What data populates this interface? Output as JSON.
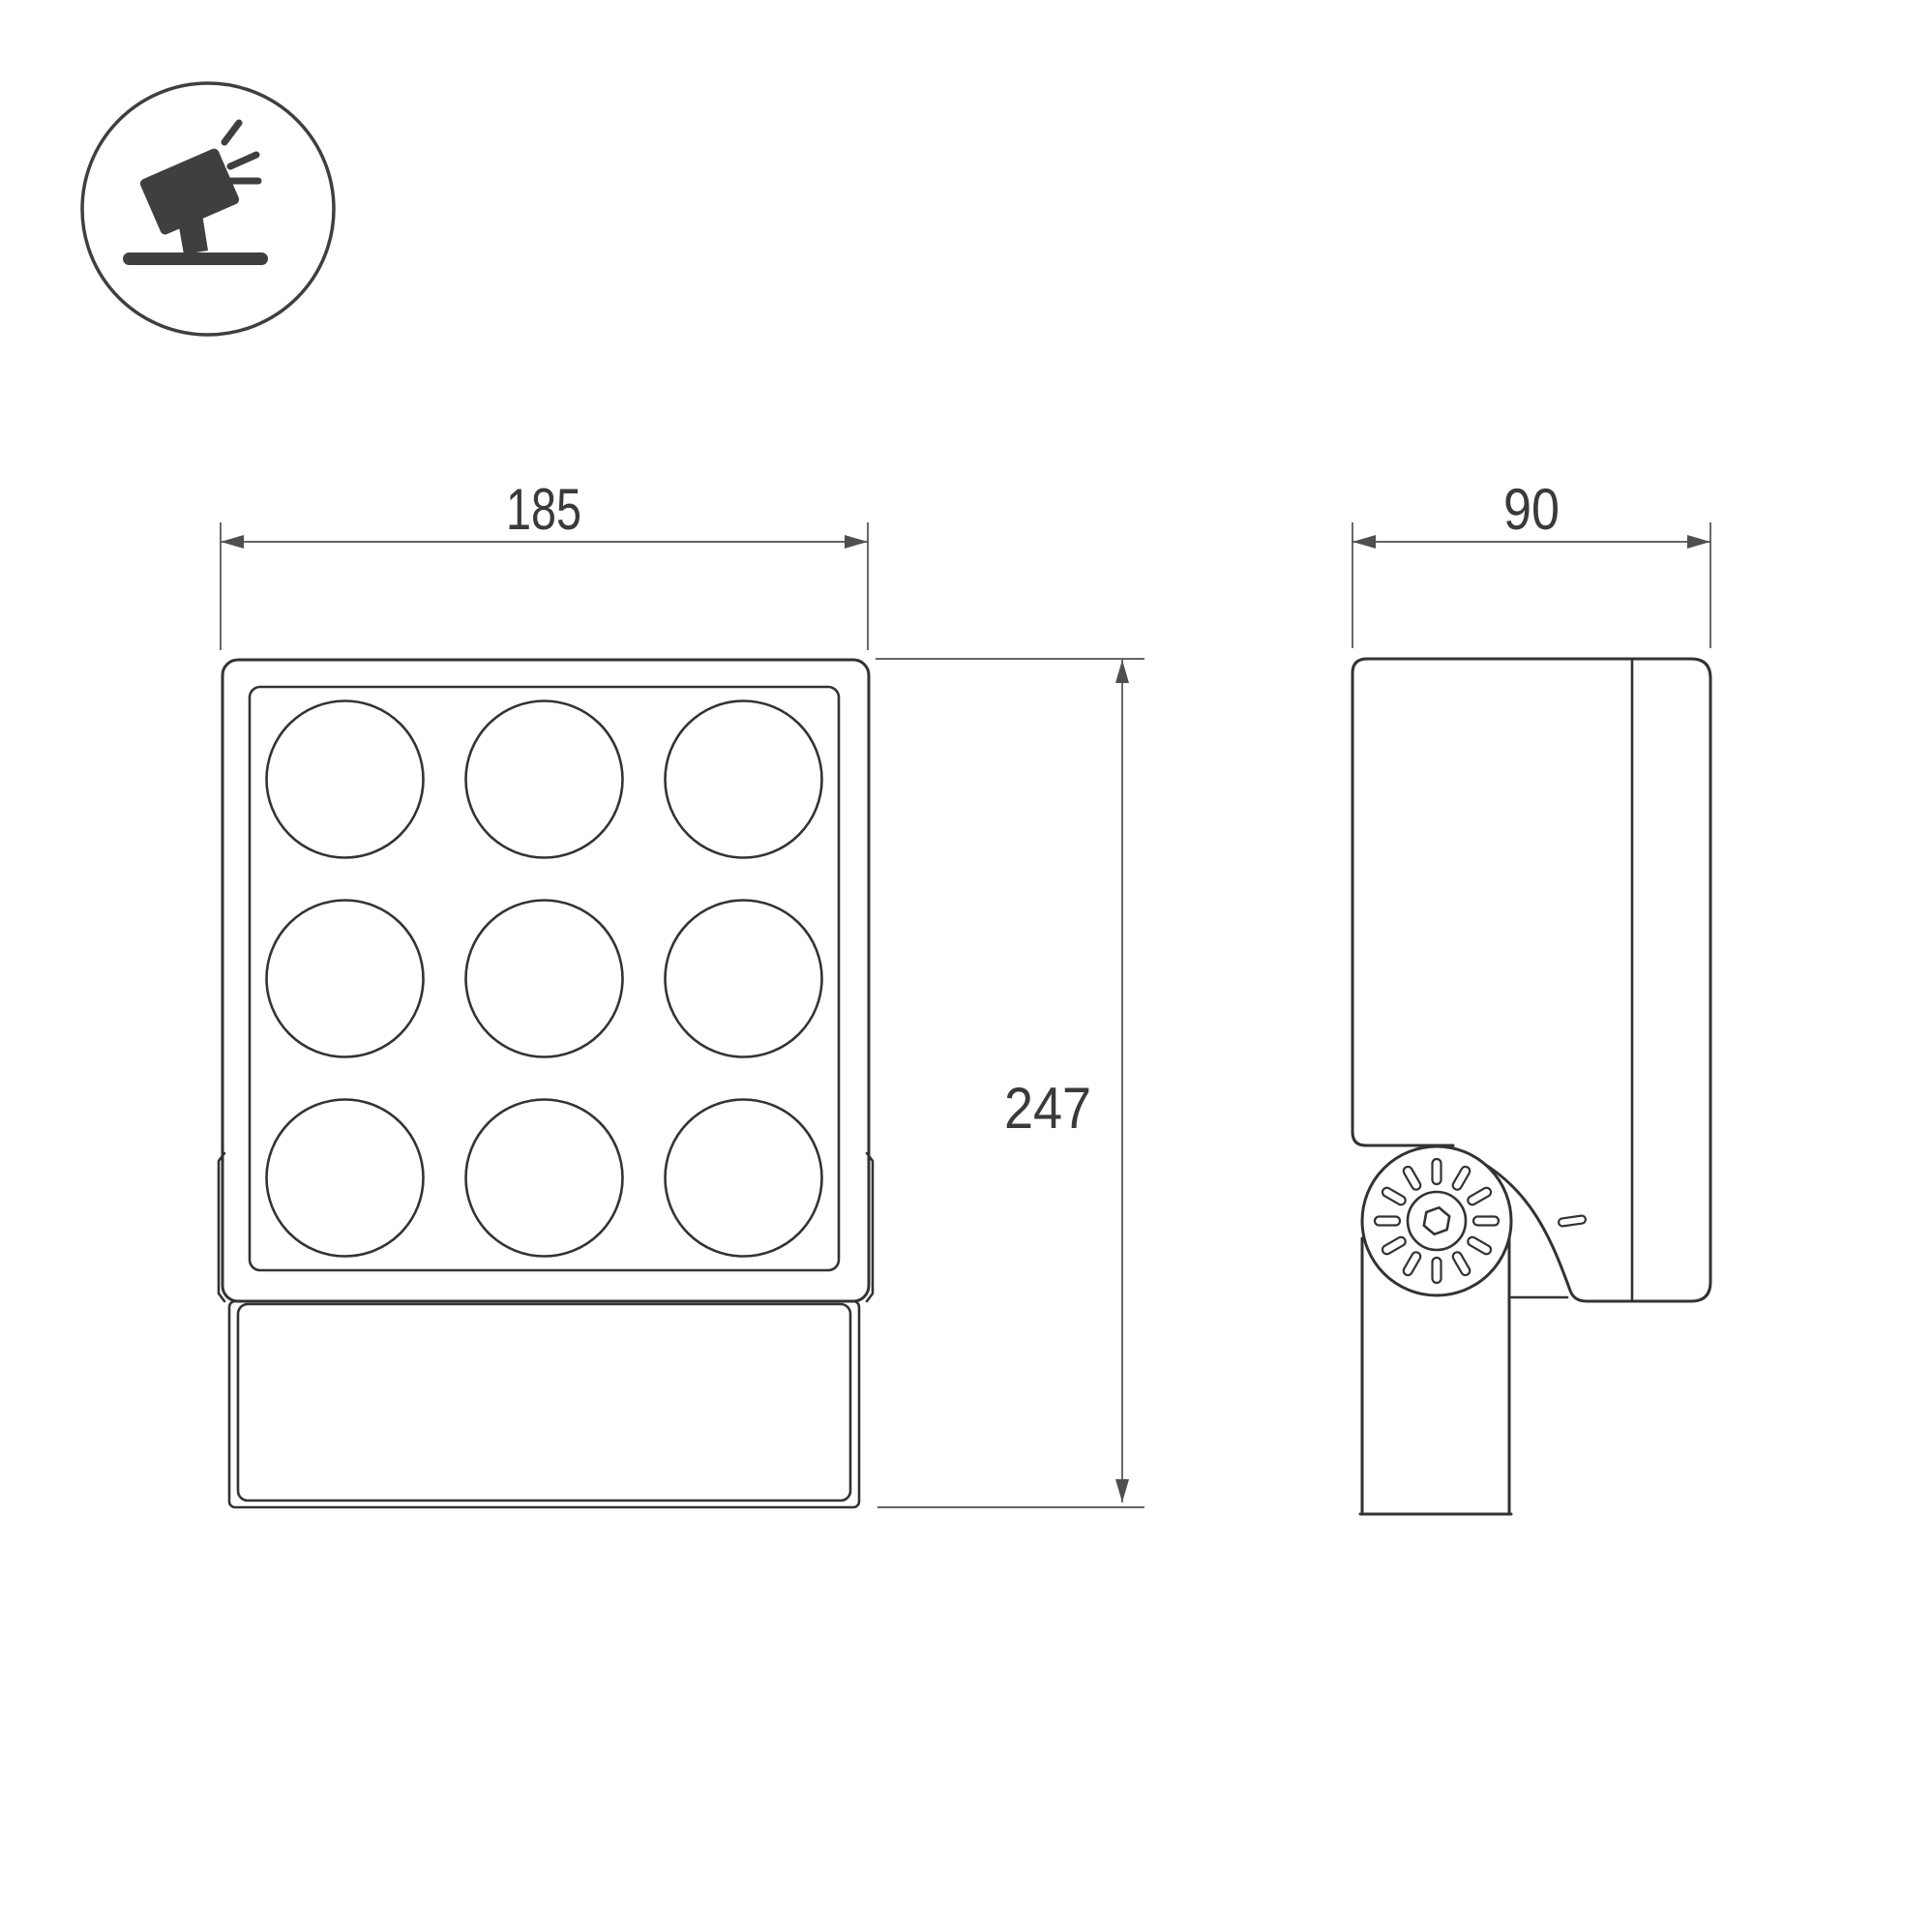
{
  "icon": {
    "name": "tilted-floodlight-on-ground-icon",
    "color": "#3f3f3f"
  },
  "dimensions": {
    "front_width": "185",
    "front_height": "247",
    "side_depth": "90"
  },
  "front_view": {
    "lens_grid": {
      "rows": 3,
      "cols": 3,
      "count": 9
    }
  },
  "side_view": {
    "knob_slots": 12,
    "screw": "hex-socket"
  },
  "colors": {
    "outline": "#333333",
    "dimension_line": "#4f4f4f",
    "dimension_text": "#3a3a3a",
    "background": "#ffffff"
  }
}
